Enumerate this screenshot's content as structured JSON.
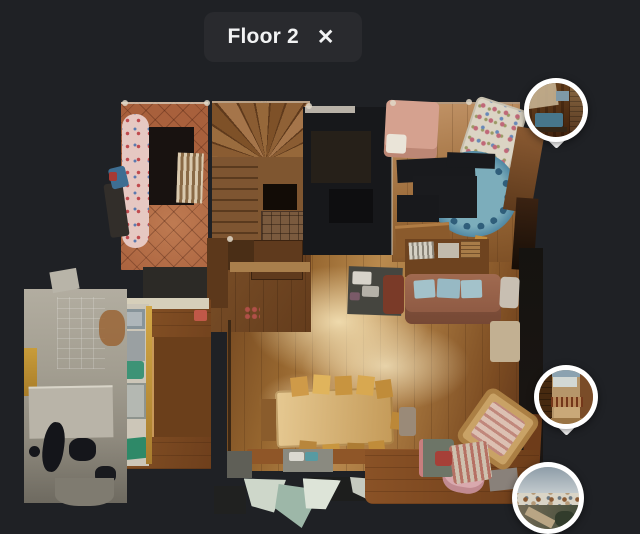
{
  "header": {
    "title": "Floor 2",
    "close_icon": "✕"
  },
  "colors": {
    "background": "#1f2125",
    "panel": "#292a2e",
    "title_text": "#f2f3f4",
    "pin_ring": "#ffffff"
  },
  "floorplan": {
    "view": "top-down-3d-scan",
    "regions": [
      "tiled-lounge",
      "winder-staircase",
      "dark-bedroom",
      "pink-bed-bedroom",
      "crib-bedroom",
      "landing-hall",
      "leather-sofa-lounge",
      "living-room",
      "dining-area",
      "kitchen",
      "utility-room",
      "reading-corner"
    ]
  },
  "pins": [
    {
      "name": "pano-pin-upper",
      "view": "balcony-interior-thumbnail",
      "shape": "teardrop"
    },
    {
      "name": "pano-pin-middle",
      "view": "terrace-interior-thumbnail",
      "shape": "teardrop"
    },
    {
      "name": "pano-pin-lower",
      "view": "village-exterior-thumbnail",
      "shape": "circle"
    }
  ]
}
